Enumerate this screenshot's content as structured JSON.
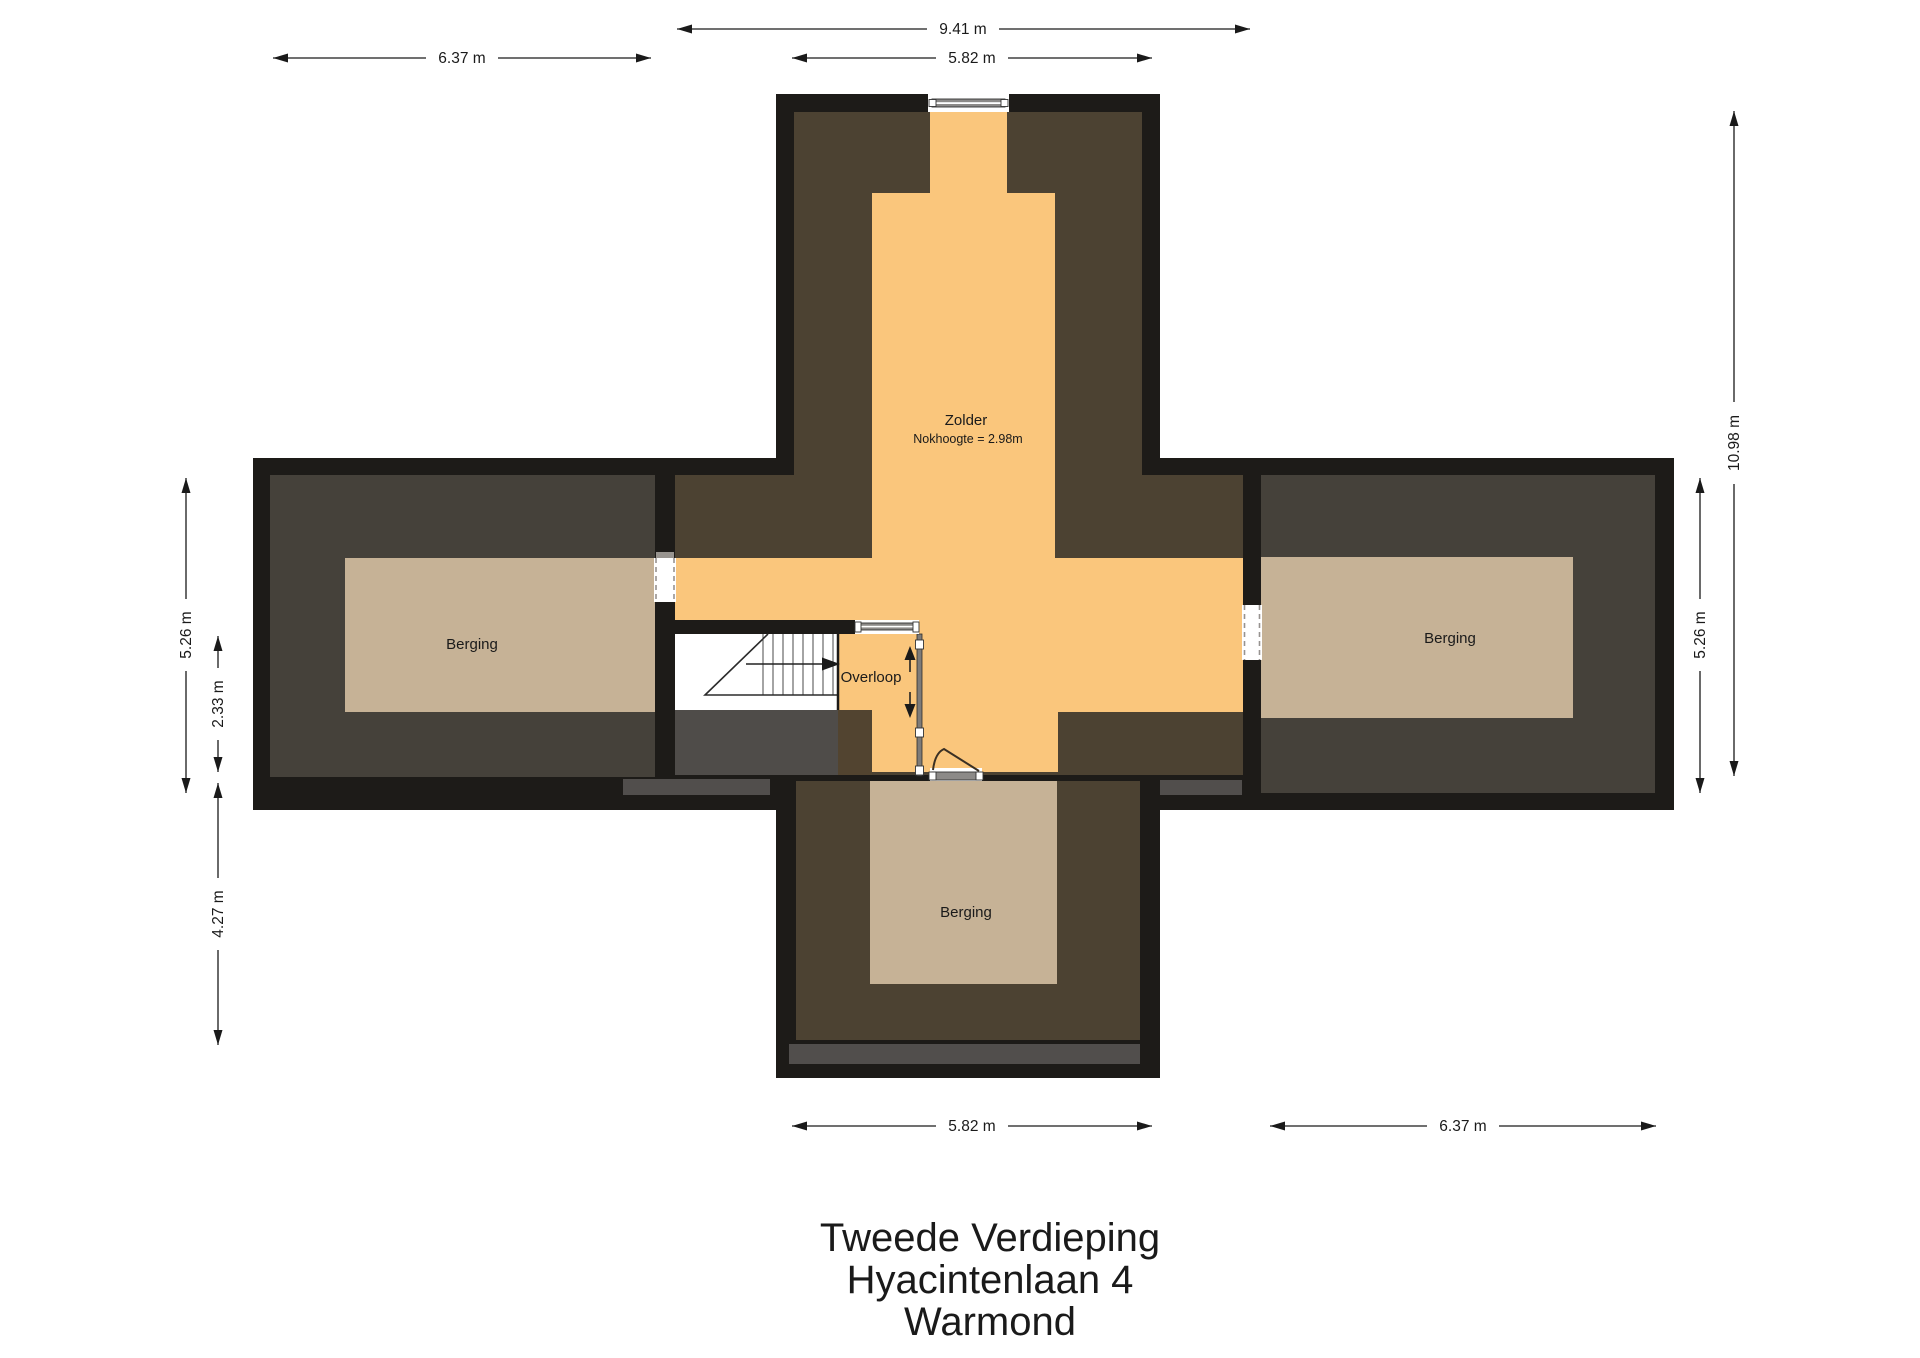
{
  "title": {
    "lines": [
      "Tweede Verdieping",
      "Hyacintenlaan 4",
      "Warmond"
    ]
  },
  "rooms": {
    "zolder": {
      "label": "Zolder",
      "note": "Nokhoogte = 2.98m"
    },
    "berging_left": {
      "label": "Berging"
    },
    "berging_right": {
      "label": "Berging"
    },
    "berging_bottom": {
      "label": "Berging"
    },
    "overloop": {
      "label": "Overloop"
    }
  },
  "dimensions": {
    "top_span": "9.41 m",
    "top_left_wing": "6.37 m",
    "top_center_wing": "5.82 m",
    "left_wing_depth": "5.26 m",
    "left_stair_zone": "2.33 m",
    "left_bottom_wing": "4.27 m",
    "right_total": "10.98 m",
    "right_wing_depth": "5.26 m",
    "bottom_center_wing": "5.82 m",
    "bottom_right_wing": "6.37 m"
  },
  "colors": {
    "page_bg": "#ffffff",
    "wall": "#1d1b18",
    "center_brown": "#4c4232",
    "wing_brown": "#45413a",
    "orange": "#fac67c",
    "tan": "#c6b296",
    "overlay_gray": "#4f4c49",
    "overlay_brown": "#524430",
    "strip_gray": "#514e4c",
    "door_gray": "#8c8a88",
    "dim_color": "#1a1a1a",
    "text_color": "#1a1a1a"
  }
}
